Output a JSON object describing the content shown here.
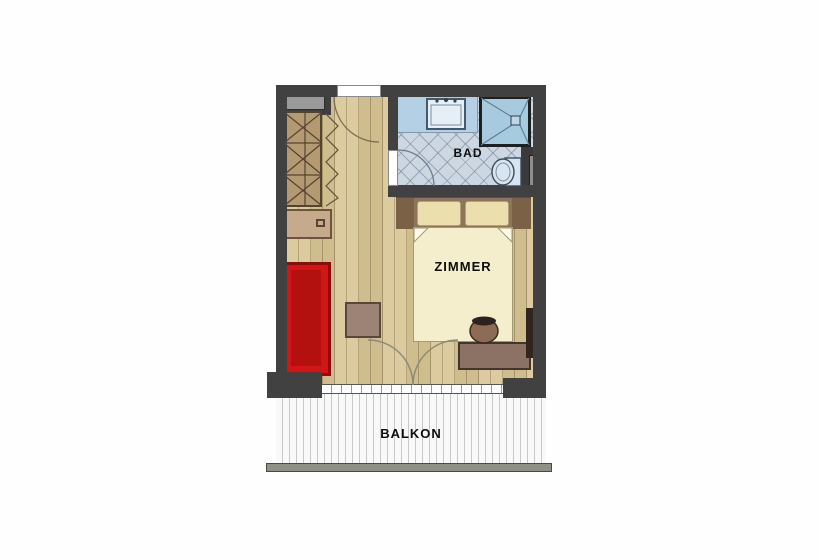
{
  "title": "Hotel room floor plan",
  "rooms": {
    "bad": {
      "label": "BAD"
    },
    "zimmer": {
      "label": "ZIMMER"
    },
    "balkon": {
      "label": "BALKON"
    }
  },
  "furniture_icons": [
    "wardrobe-icon",
    "dresser-icon",
    "sofa-icon",
    "side-table-icon",
    "double-bed-icon",
    "pillow-icon",
    "nightstand-icon",
    "desk-icon",
    "stool-icon",
    "tv-panel-icon",
    "vanity-sink-icon",
    "shower-icon",
    "toilet-icon",
    "duct-shaft-icon",
    "door-swing-icon",
    "railing-icon"
  ],
  "colors": {
    "wall": "#414141",
    "room_floor": "#d7c593",
    "bath_floor": "#ccd7e2",
    "balcony_floor": "#f5f5f5",
    "sofa_red": "#d41515",
    "bed_duvet": "#f4eecd",
    "furniture_brown": "#8b7264",
    "shower_blue": "#a6cbdf",
    "railing_gray": "#8f9086"
  }
}
